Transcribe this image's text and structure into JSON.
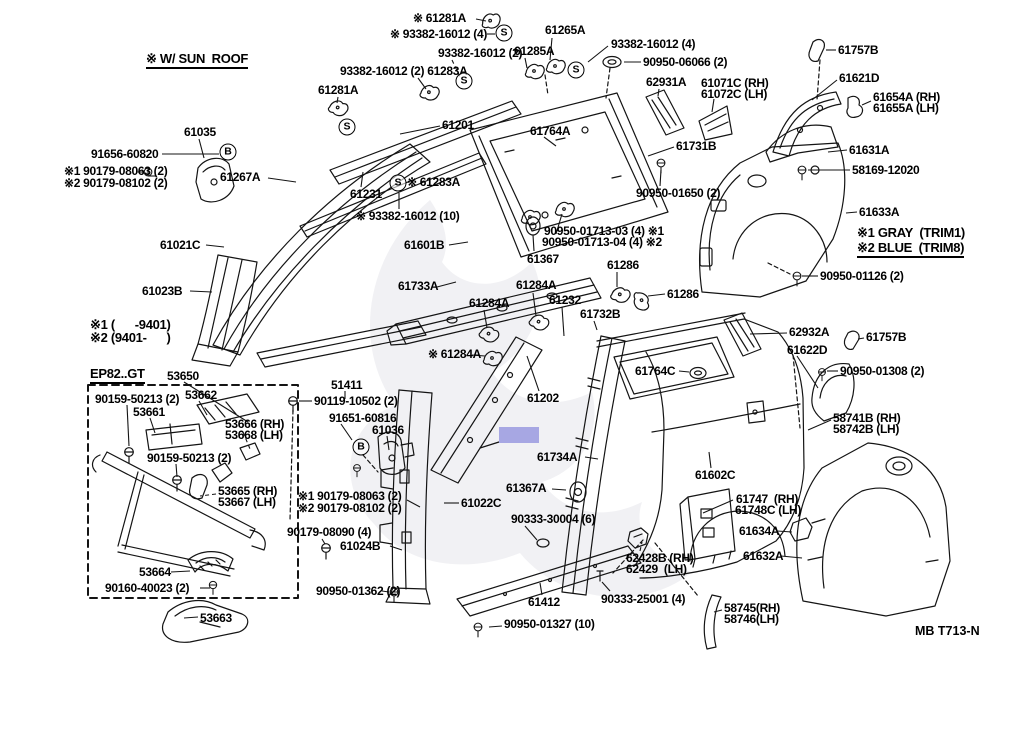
{
  "diagram": {
    "code": "MB T713-N",
    "highlight": {
      "x": 499,
      "y": 427,
      "w": 40,
      "h": 16,
      "color": "#a7a7e3"
    },
    "symbols": [
      {
        "g": "S",
        "x": 504,
        "y": 33
      },
      {
        "g": "S",
        "x": 464,
        "y": 81
      },
      {
        "g": "S",
        "x": 576,
        "y": 70
      },
      {
        "g": "S",
        "x": 347,
        "y": 127
      },
      {
        "g": "S",
        "x": 398,
        "y": 183
      },
      {
        "g": "B",
        "x": 228,
        "y": 152
      },
      {
        "g": "B",
        "x": 361,
        "y": 447
      }
    ],
    "labels": [
      {
        "t": "※ W/ SUN  ROOF",
        "x": 146,
        "y": 52,
        "fs": 13,
        "u": 1
      },
      {
        "t": "※ 61281A",
        "x": 413,
        "y": 12,
        "l": [
          476,
          19,
          486,
          21
        ]
      },
      {
        "t": "※ 93382-16012 (4)",
        "x": 390,
        "y": 28,
        "l": [
          487,
          34,
          495,
          34
        ]
      },
      {
        "t": "93382-16012 (2)",
        "x": 438,
        "y": 47,
        "l": [
          452,
          60,
          460,
          77
        ],
        "d": 1
      },
      {
        "t": "61265A",
        "x": 545,
        "y": 24,
        "l": [
          552,
          38,
          550,
          60
        ]
      },
      {
        "t": "61285A",
        "x": 514,
        "y": 45,
        "l": [
          525,
          58,
          527,
          68
        ]
      },
      {
        "t": "93382-16012 (4)",
        "x": 611,
        "y": 38,
        "l": [
          608,
          46,
          588,
          62
        ]
      },
      {
        "t": "90950-06066 (2)",
        "x": 643,
        "y": 56,
        "l": [
          641,
          62,
          624,
          62
        ]
      },
      {
        "t": "93382-16012 (2) 61283A",
        "x": 340,
        "y": 65,
        "l": [
          418,
          78,
          426,
          89
        ]
      },
      {
        "t": "62931A",
        "x": 646,
        "y": 76,
        "l": [
          659,
          89,
          658,
          96
        ]
      },
      {
        "t": "61281A",
        "x": 318,
        "y": 84,
        "l": [
          338,
          97,
          337,
          103
        ]
      },
      {
        "t": "61757B",
        "x": 838,
        "y": 44,
        "l": [
          836,
          50,
          826,
          50
        ]
      },
      {
        "t": "61621D",
        "x": 839,
        "y": 72,
        "l": [
          837,
          80,
          812,
          100
        ]
      },
      {
        "t": "61071C (RH)",
        "x": 701,
        "y": 77
      },
      {
        "t": "61072C (LH)",
        "x": 701,
        "y": 88,
        "l": [
          714,
          99,
          712,
          112
        ]
      },
      {
        "t": "61201",
        "x": 442,
        "y": 119,
        "l": [
          440,
          126,
          400,
          134
        ]
      },
      {
        "t": "61764A",
        "x": 530,
        "y": 125,
        "l": [
          544,
          137,
          556,
          146
        ]
      },
      {
        "t": "61035",
        "x": 184,
        "y": 126,
        "l": [
          199,
          139,
          204,
          158
        ]
      },
      {
        "t": "61731B",
        "x": 676,
        "y": 140,
        "l": [
          674,
          147,
          648,
          156
        ]
      },
      {
        "t": "61631A",
        "x": 849,
        "y": 144,
        "l": [
          847,
          150,
          828,
          152
        ]
      },
      {
        "t": "61654A (RH)",
        "x": 873,
        "y": 91
      },
      {
        "t": "61655A (LH)",
        "x": 873,
        "y": 102,
        "l": [
          871,
          101,
          862,
          105
        ]
      },
      {
        "t": "91656-60820",
        "x": 91,
        "y": 148,
        "l": [
          162,
          154,
          219,
          154
        ]
      },
      {
        "t": "58169-12020",
        "x": 852,
        "y": 164,
        "l": [
          850,
          170,
          808,
          170
        ]
      },
      {
        "t": "※1 90179-08063 (2)",
        "x": 64,
        "y": 165
      },
      {
        "t": "※2 90179-08102 (2)",
        "x": 64,
        "y": 177,
        "l": [
          148,
          176,
          156,
          176
        ]
      },
      {
        "t": "61267A",
        "x": 220,
        "y": 171,
        "l": [
          268,
          178,
          296,
          182
        ]
      },
      {
        "t": "※ 61283A",
        "x": 407,
        "y": 176
      },
      {
        "t": "61231",
        "x": 350,
        "y": 188,
        "l": [
          361,
          187,
          363,
          172
        ]
      },
      {
        "t": "90950-01650 (2)",
        "x": 636,
        "y": 187,
        "l": [
          660,
          186,
          661,
          170
        ]
      },
      {
        "t": "61633A",
        "x": 859,
        "y": 206,
        "l": [
          857,
          212,
          846,
          213
        ]
      },
      {
        "t": "※ 93382-16012 (10)",
        "x": 356,
        "y": 210,
        "l": [
          399,
          209,
          399,
          193
        ]
      },
      {
        "t": "90950-01713-03 (4) ※1",
        "x": 544,
        "y": 225
      },
      {
        "t": "90950-01713-04 (4) ※2",
        "x": 542,
        "y": 236,
        "l": [
          556,
          234,
          562,
          214
        ]
      },
      {
        "t": "61021C",
        "x": 160,
        "y": 239,
        "l": [
          206,
          245,
          224,
          247
        ]
      },
      {
        "t": "61601B",
        "x": 404,
        "y": 239,
        "l": [
          449,
          245,
          468,
          242
        ]
      },
      {
        "t": "※1 GRAY  (TRIM1)",
        "x": 857,
        "y": 226,
        "fs": 13
      },
      {
        "t": "※2 BLUE  (TRIM8)",
        "x": 857,
        "y": 241,
        "fs": 13,
        "u": 1
      },
      {
        "t": "61367",
        "x": 527,
        "y": 253,
        "l": [
          534,
          251,
          533,
          235
        ]
      },
      {
        "t": "61286",
        "x": 607,
        "y": 259,
        "l": [
          617,
          272,
          617,
          287
        ]
      },
      {
        "t": "90950-01126 (2)",
        "x": 820,
        "y": 270,
        "l": [
          818,
          276,
          802,
          276
        ]
      },
      {
        "t": "61023B",
        "x": 142,
        "y": 285,
        "l": [
          190,
          291,
          212,
          292
        ]
      },
      {
        "t": "61733A",
        "x": 398,
        "y": 280,
        "l": [
          437,
          287,
          456,
          282
        ]
      },
      {
        "t": "61284A",
        "x": 516,
        "y": 279,
        "l": [
          533,
          293,
          536,
          316
        ]
      },
      {
        "t": "61286",
        "x": 667,
        "y": 288,
        "l": [
          665,
          294,
          648,
          296
        ]
      },
      {
        "t": "61232",
        "x": 549,
        "y": 294,
        "l": [
          562,
          307,
          564,
          336
        ]
      },
      {
        "t": "61284A",
        "x": 469,
        "y": 297,
        "l": [
          484,
          310,
          487,
          328
        ]
      },
      {
        "t": "61732B",
        "x": 580,
        "y": 308,
        "l": [
          594,
          321,
          597,
          330
        ]
      },
      {
        "t": "※1 (      -9401)",
        "x": 90,
        "y": 318,
        "fs": 13
      },
      {
        "t": "※2 (9401-      )",
        "x": 90,
        "y": 331,
        "fs": 13
      },
      {
        "t": "62932A",
        "x": 789,
        "y": 326,
        "l": [
          787,
          333,
          750,
          334
        ]
      },
      {
        "t": "61757B",
        "x": 866,
        "y": 331,
        "l": [
          864,
          338,
          858,
          339
        ]
      },
      {
        "t": "61622D",
        "x": 787,
        "y": 344,
        "l": [
          797,
          356,
          818,
          388
        ]
      },
      {
        "t": "※ 61284A",
        "x": 428,
        "y": 348,
        "l": [
          472,
          355,
          485,
          356
        ]
      },
      {
        "t": "90950-01308 (2)",
        "x": 840,
        "y": 365,
        "l": [
          838,
          371,
          827,
          371
        ]
      },
      {
        "t": "61764C",
        "x": 635,
        "y": 365,
        "l": [
          679,
          371,
          689,
          372
        ]
      },
      {
        "t": "EP82..GT",
        "x": 90,
        "y": 367,
        "fs": 13,
        "u": 1
      },
      {
        "t": "53650",
        "x": 167,
        "y": 370,
        "l": [
          184,
          382,
          248,
          422
        ]
      },
      {
        "t": "51411",
        "x": 331,
        "y": 379,
        "l": [
          345,
          391,
          345,
          399
        ]
      },
      {
        "t": "61202",
        "x": 527,
        "y": 392,
        "l": [
          539,
          391,
          527,
          356
        ]
      },
      {
        "t": "90159-50213 (2)",
        "x": 95,
        "y": 393,
        "l": [
          127,
          405,
          129,
          446
        ]
      },
      {
        "t": "53662",
        "x": 185,
        "y": 389,
        "l": [
          199,
          401,
          207,
          415
        ]
      },
      {
        "t": "90119-10502 (2)",
        "x": 314,
        "y": 395,
        "l": [
          312,
          401,
          299,
          401
        ]
      },
      {
        "t": "53661",
        "x": 133,
        "y": 406,
        "l": [
          150,
          418,
          155,
          433
        ]
      },
      {
        "t": "58741B (RH)",
        "x": 833,
        "y": 412
      },
      {
        "t": "58742B (LH)",
        "x": 833,
        "y": 423,
        "l": [
          831,
          420,
          808,
          430
        ]
      },
      {
        "t": "91651-60816",
        "x": 329,
        "y": 412,
        "l": [
          341,
          424,
          352,
          440
        ]
      },
      {
        "t": "53666 (RH)",
        "x": 225,
        "y": 418
      },
      {
        "t": "53668 (LH)",
        "x": 225,
        "y": 429,
        "l": [
          243,
          432,
          250,
          449
        ],
        "d": 1
      },
      {
        "t": "61036",
        "x": 372,
        "y": 424,
        "l": [
          387,
          436,
          389,
          450
        ]
      },
      {
        "t": "61734A",
        "x": 537,
        "y": 451,
        "l": [
          585,
          457,
          598,
          459
        ]
      },
      {
        "t": "90159-50213 (2)",
        "x": 147,
        "y": 452,
        "l": [
          176,
          464,
          177,
          477
        ]
      },
      {
        "t": "61602C",
        "x": 695,
        "y": 469,
        "l": [
          711,
          468,
          709,
          452
        ]
      },
      {
        "t": "61367A",
        "x": 506,
        "y": 482,
        "l": [
          552,
          489,
          566,
          490
        ]
      },
      {
        "t": "53665 (RH)",
        "x": 218,
        "y": 485
      },
      {
        "t": "53667 (LH)",
        "x": 218,
        "y": 496,
        "l": [
          216,
          494,
          200,
          496
        ],
        "d": 1
      },
      {
        "t": "※1 90179-08063 (2)",
        "x": 298,
        "y": 490
      },
      {
        "t": "※2 90179-08102 (2)",
        "x": 298,
        "y": 502,
        "l": [
          407,
          500,
          420,
          507
        ]
      },
      {
        "t": "61747  (RH)",
        "x": 736,
        "y": 493
      },
      {
        "t": "61748C (LH)",
        "x": 735,
        "y": 504,
        "l": [
          733,
          500,
          703,
          513
        ]
      },
      {
        "t": "61022C",
        "x": 461,
        "y": 497,
        "l": [
          459,
          503,
          444,
          503
        ]
      },
      {
        "t": "90333-30004 (6)",
        "x": 511,
        "y": 513,
        "l": [
          525,
          526,
          537,
          540
        ]
      },
      {
        "t": "61634A",
        "x": 739,
        "y": 525,
        "l": [
          777,
          531,
          792,
          532
        ]
      },
      {
        "t": "90179-08090 (4)",
        "x": 287,
        "y": 526,
        "l": [
          322,
          539,
          325,
          544
        ]
      },
      {
        "t": "61024B",
        "x": 340,
        "y": 540,
        "l": [
          390,
          546,
          402,
          550
        ]
      },
      {
        "t": "61632A",
        "x": 743,
        "y": 550,
        "l": [
          781,
          556,
          802,
          558
        ]
      },
      {
        "t": "62428B (RH)",
        "x": 626,
        "y": 552
      },
      {
        "t": "62429  (LH)",
        "x": 626,
        "y": 563,
        "l": [
          640,
          551,
          642,
          542
        ],
        "d": 1
      },
      {
        "t": "53664",
        "x": 139,
        "y": 566,
        "l": [
          171,
          572,
          190,
          571
        ]
      },
      {
        "t": "90950-01362 (2)",
        "x": 316,
        "y": 585,
        "l": [
          382,
          591,
          389,
          592
        ]
      },
      {
        "t": "90160-40023 (2)",
        "x": 105,
        "y": 582,
        "l": [
          200,
          588,
          210,
          588
        ]
      },
      {
        "t": "61412",
        "x": 528,
        "y": 596,
        "l": [
          542,
          595,
          540,
          583
        ]
      },
      {
        "t": "90333-25001 (4)",
        "x": 601,
        "y": 593,
        "l": [
          610,
          591,
          602,
          582
        ]
      },
      {
        "t": "58745(RH)",
        "x": 724,
        "y": 602
      },
      {
        "t": "58746(LH)",
        "x": 724,
        "y": 613,
        "l": [
          722,
          610,
          714,
          612
        ]
      },
      {
        "t": "53663",
        "x": 200,
        "y": 612,
        "l": [
          198,
          617,
          184,
          618
        ]
      },
      {
        "t": "90950-01327 (10)",
        "x": 504,
        "y": 618,
        "l": [
          502,
          626,
          489,
          627
        ]
      }
    ]
  }
}
